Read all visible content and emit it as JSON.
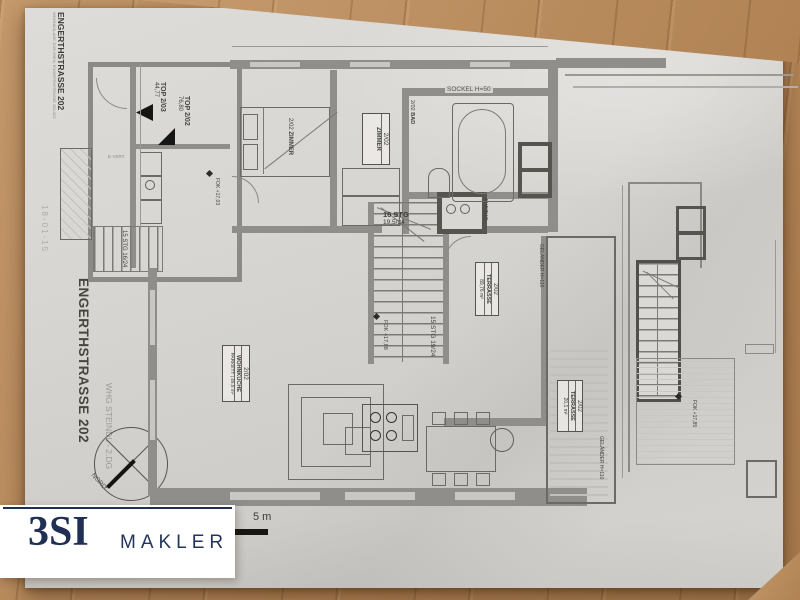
{
  "logo": {
    "brand": "3SI",
    "word": "MAKLER"
  },
  "corner": {
    "title": "ENGERTHSTRASSE 202",
    "sub": "WOHNANLAGE 1020 WIEN, ENGERTHSTRASSE 200-202"
  },
  "stamp": "18-01-15",
  "title": "ENGERTHSTRASSE 202",
  "subtitle": "WHG STEINDL - 2.DG",
  "compass": "NORD",
  "scale": "5 m",
  "units": {
    "u1": {
      "name": "TOP 2/03",
      "area": "44,77"
    },
    "u2": {
      "name": "TOP 2/02",
      "area": "76,80"
    }
  },
  "stairs": {
    "annex": "15 STG 16/24",
    "up1": "16 STG",
    "up2": "19,5/24",
    "down": "15 STG 19/24"
  },
  "levels": {
    "annex": "FOK +17,03",
    "main": "FOK +17,88",
    "roof": "FOK +17,85"
  },
  "notes": {
    "lift": "AUFZUG",
    "sockel": "SOCKEL H=50",
    "rail1": "GELÄNDER H=110",
    "rail2": "GELÄNDER H=110",
    "evert": "E-VERT."
  },
  "rooms": {
    "zimmer1": {
      "nr": "2/02",
      "name": "ZIMMER"
    },
    "zimmer2": {
      "nr": "2/02",
      "name": "ZIMMER"
    },
    "bad": {
      "nr": "2/02",
      "name": "BAD"
    },
    "kueche": {
      "nr": "2/02",
      "name": "WOHNKÜCHE",
      "floor": "PARKETT",
      "area": "45,5 m²"
    },
    "terrasse1": {
      "nr": "2/02",
      "name": "TERRASSE",
      "area": "89,76 m²"
    },
    "terrasse2": {
      "nr": "2/02",
      "name": "TERRASSE",
      "area": "20,1 m²"
    }
  }
}
